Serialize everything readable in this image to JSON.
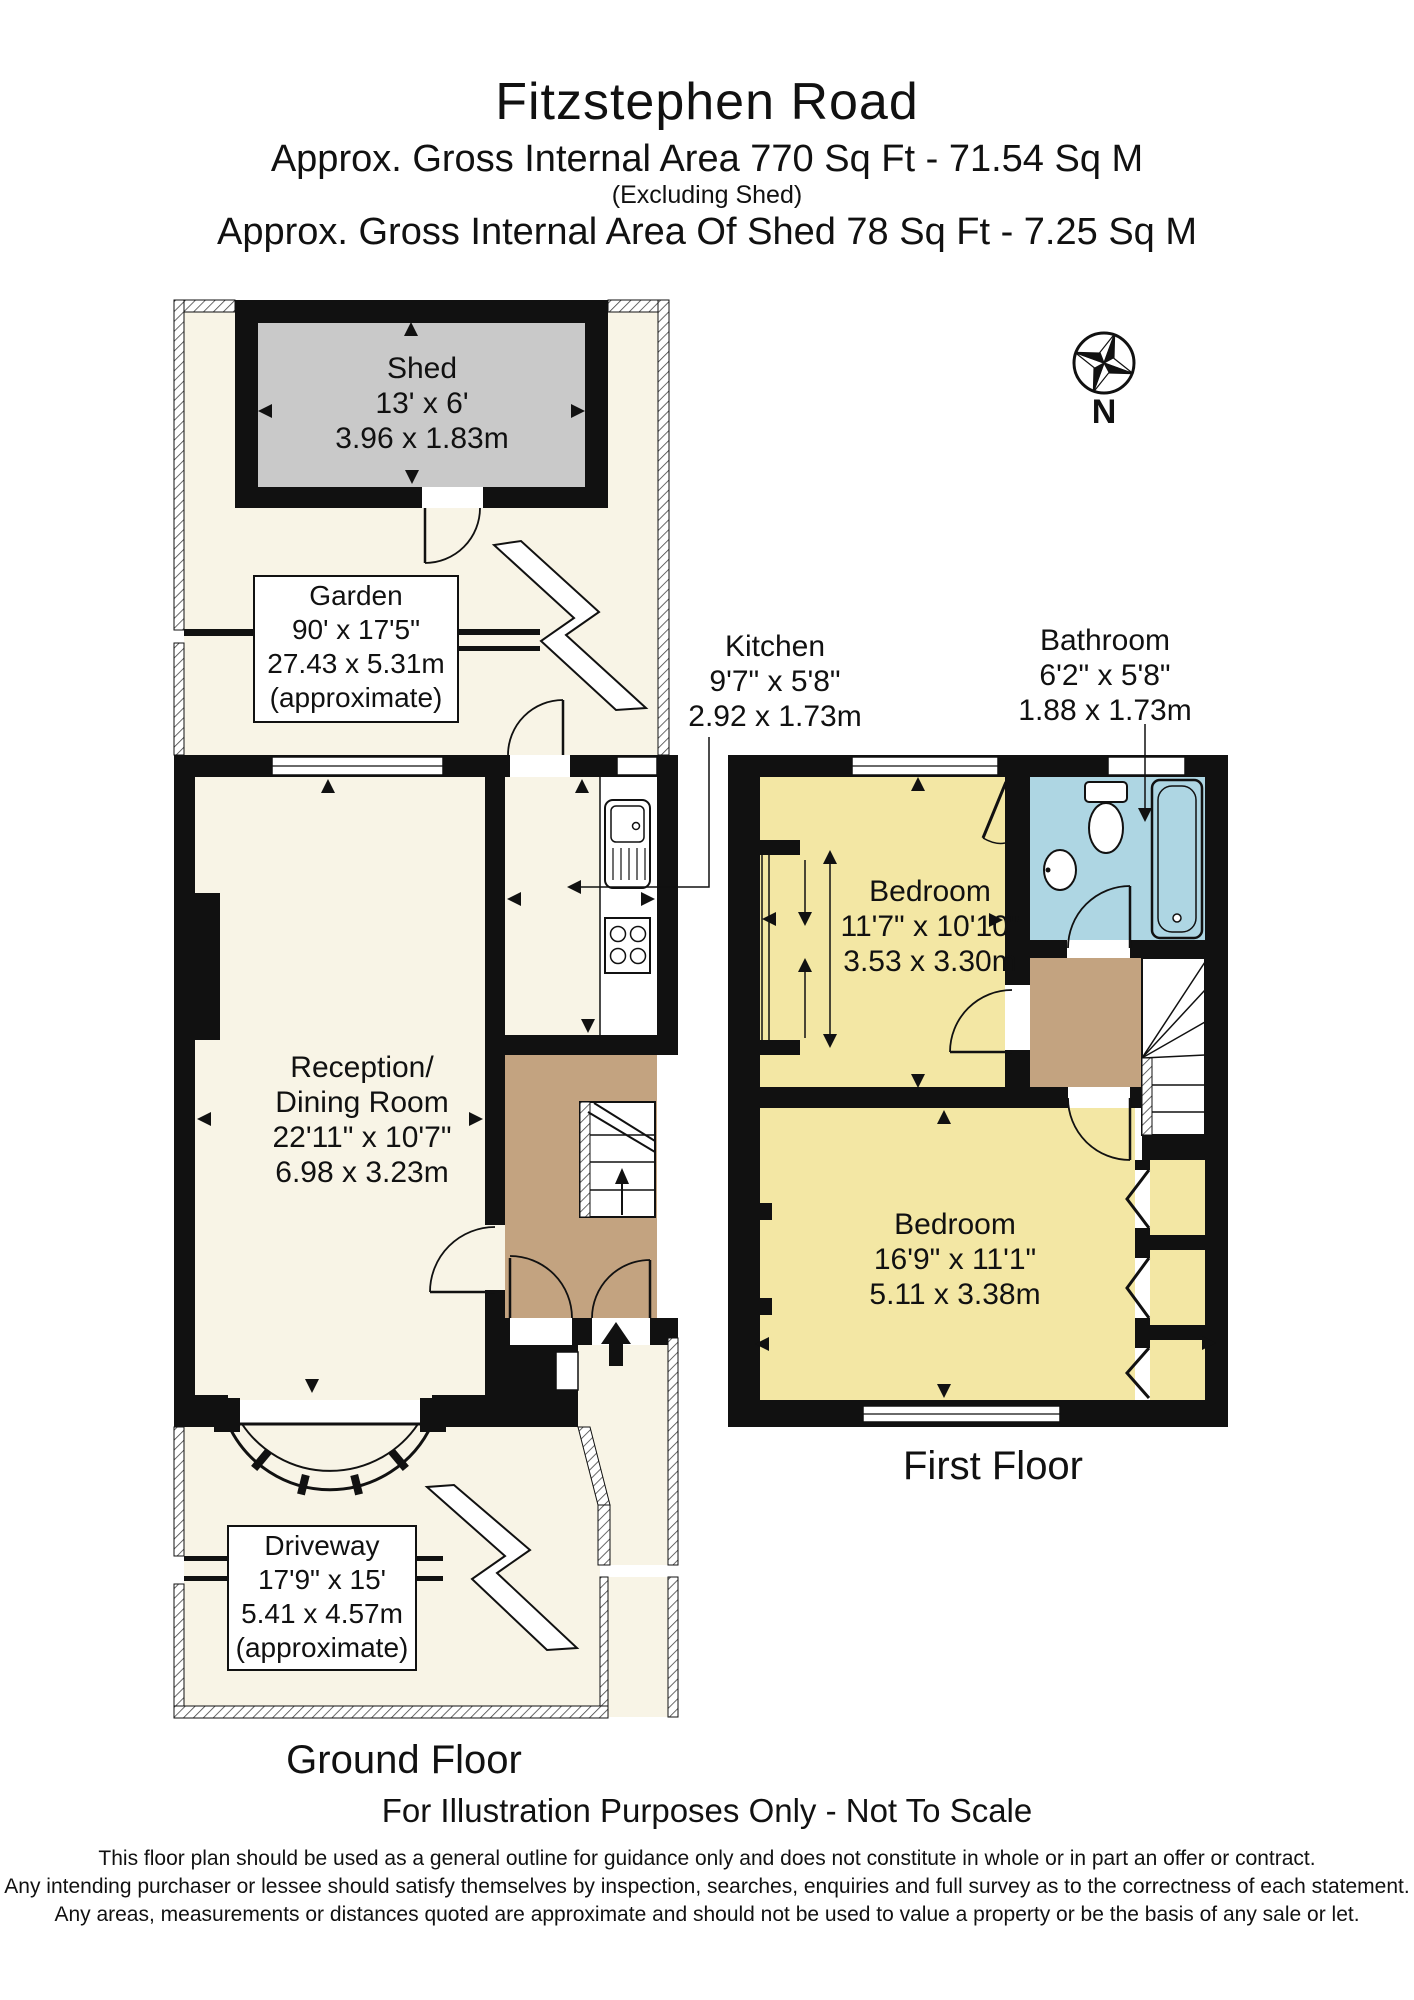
{
  "title": {
    "line1": "Fitzstephen Road",
    "line2": "Approx. Gross Internal Area   770 Sq Ft  -  71.54 Sq M",
    "line3": "(Excluding Shed)",
    "line4": "Approx. Gross Internal Area Of Shed  78 Sq Ft  -  7.25 Sq M"
  },
  "compass": {
    "north_label": "N"
  },
  "rooms": {
    "shed": {
      "name": "Shed",
      "imperial": "13' x 6'",
      "metric": "3.96 x 1.83m"
    },
    "garden": {
      "name": "Garden",
      "imperial": "90' x 17'5\"",
      "metric": "27.43 x 5.31m",
      "note": "(approximate)"
    },
    "kitchen": {
      "name": "Kitchen",
      "imperial": "9'7\" x 5'8\"",
      "metric": "2.92 x 1.73m"
    },
    "bathroom": {
      "name": "Bathroom",
      "imperial": "6'2\" x 5'8\"",
      "metric": "1.88 x 1.73m"
    },
    "bedroom1": {
      "name": "Bedroom",
      "imperial": "11'7\" x 10'10\"",
      "metric": "3.53 x 3.30m"
    },
    "bedroom2": {
      "name": "Bedroom",
      "imperial": "16'9\" x 11'1\"",
      "metric": "5.11 x 3.38m"
    },
    "reception": {
      "name1": "Reception/",
      "name2": "Dining Room",
      "imperial": "22'11\" x 10'7\"",
      "metric": "6.98 x 3.23m"
    },
    "driveway": {
      "name": "Driveway",
      "imperial": "17'9\" x 15'",
      "metric": "5.41 x 4.57m",
      "note": "(approximate)"
    }
  },
  "floors": {
    "ground": "Ground Floor",
    "first": "First Floor"
  },
  "footer": {
    "notice": "For Illustration Purposes Only - Not To Scale",
    "disclaimer1": "This floor plan should be used as a general outline for guidance only and does not constitute in whole or in part an offer or contract.",
    "disclaimer2": "Any intending purchaser or lessee should satisfy themselves by inspection, searches, enquiries and full survey as to the correctness of each statement.",
    "disclaimer3": "Any areas, measurements or distances quoted are approximate and should not be used to value a property or be the basis of any sale or let."
  },
  "colors": {
    "wall": "#111111",
    "floor_cream": "#f8f4e6",
    "shed_gray": "#c9c9c9",
    "bedroom_yellow": "#f3e7a4",
    "bathroom_blue": "#aed6e3",
    "hall_tan": "#c3a380"
  }
}
